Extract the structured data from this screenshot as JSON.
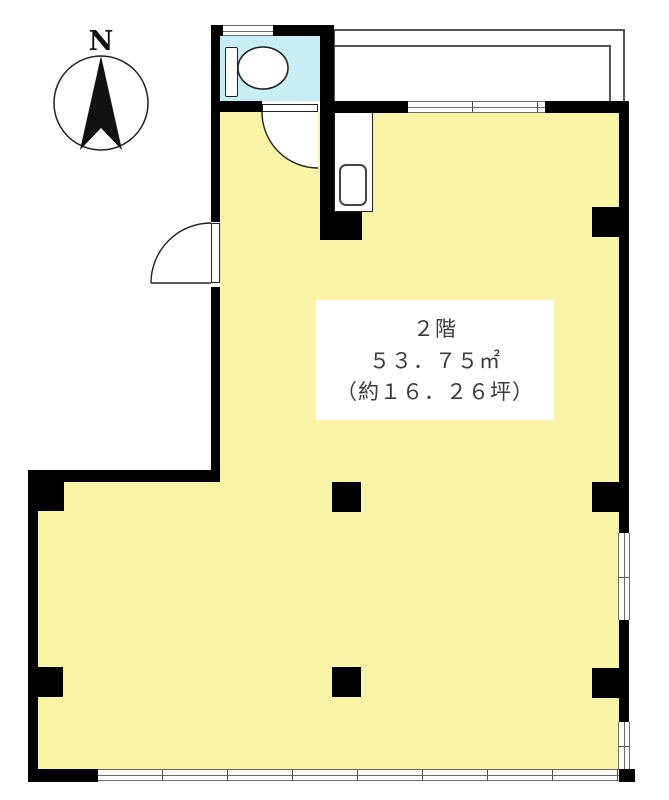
{
  "title": "2F floor plan",
  "compass": {
    "label": "N",
    "icon": "compass-icon"
  },
  "area_label": {
    "floor": "２階",
    "size_sqm": "５３．７５㎡",
    "size_tsubo": "（約１６．２６坪）"
  },
  "rooms": {
    "main": {
      "name": "main-room",
      "fill": "#F8F3A5"
    },
    "wc": {
      "name": "toilet-room",
      "fill": "#C8EDF4"
    }
  },
  "icons": {
    "compass": "compass-icon",
    "toilet": "toilet-icon",
    "sink": "sink-icon",
    "door_swing_entrance": "door-arc-icon",
    "door_swing_wc": "door-arc-icon"
  },
  "colors": {
    "room_fill": "#F8F3A5",
    "wc_fill": "#C8EDF4",
    "wall": "#000000",
    "window_line": "#6B6B6B",
    "balcony_line": "#555555",
    "ink": "#3B3B3B"
  }
}
